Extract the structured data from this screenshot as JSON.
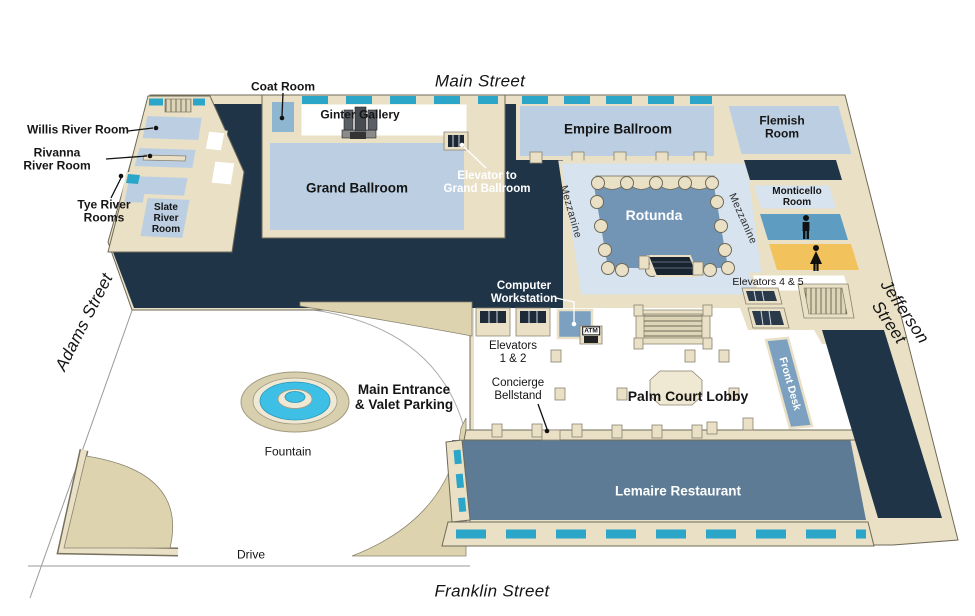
{
  "title": "Hotel ground-floor isometric map",
  "streets": {
    "top": "Main Street",
    "bottom": "Franklin Street",
    "left": "Adams Street",
    "right": "Jefferson Street"
  },
  "labels": {
    "coat_room": "Coat Room",
    "ginter_gallery": "Ginter Gallery",
    "willis_river_room": "Willis River Room",
    "rivanna_river_room": "Rivanna\nRiver Room",
    "tye_river_rooms": "Tye River\nRooms",
    "slate_river_room": "Slate\nRiver\nRoom",
    "grand_ballroom": "Grand Ballroom",
    "empire_ballroom": "Empire Ballroom",
    "flemish_room": "Flemish\nRoom",
    "elevator_to_grand_ballroom": "Elevator to\nGrand Ballroom",
    "mezzanine": "Mezzanine",
    "rotunda": "Rotunda",
    "monticello_room": "Monticello\nRoom",
    "elevators_4_5": "Elevators 4 & 5",
    "computer_workstation": "Computer\nWorkstation",
    "elevators_1_2": "Elevators\n1 & 2",
    "atm": "ATM",
    "concierge_bellstand": "Concierge\nBellstand",
    "palm_court_lobby": "Palm Court Lobby",
    "front_desk": "Front Desk",
    "main_entrance": "Main Entrance\n& Valet Parking",
    "fountain": "Fountain",
    "drive": "Drive",
    "lemaire_restaurant": "Lemaire Restaurant"
  },
  "colors": {
    "wall_cream": "#e9e0c6",
    "wall_edge": "#b7ab88",
    "line": "#6f6a58",
    "navy": "#203448",
    "room_blue": "#bccfe2",
    "mezz_blue": "#d7e3ef",
    "rotunda_blue": "#7295b6",
    "lemaire_slate": "#5e7b95",
    "window_teal": "#2ba6c8",
    "desk_blue": "#7ba0c0",
    "coat_blue": "#8fb6d0",
    "restroom_blue": "#5f9cc2",
    "restroom_yellow": "#f2c25c",
    "fountain_cyan": "#3ec0e6",
    "tan": "#ddd3ae"
  }
}
